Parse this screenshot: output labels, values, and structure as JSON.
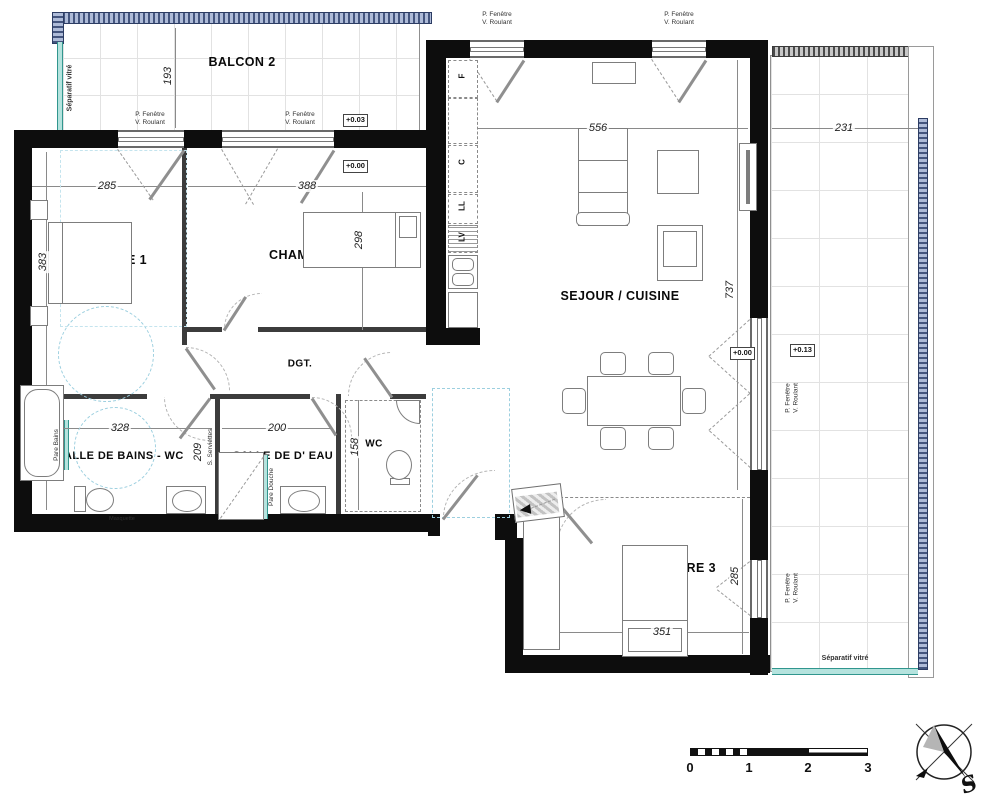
{
  "rooms": {
    "balcon2": "BALCON 2",
    "chambre1": "CHAMBRE 1",
    "chambre2": "CHAMBRE 2",
    "sejour": "SEJOUR / CUISINE",
    "balcon1": "BALCON 1",
    "dgt": "DGT.",
    "sdb": "SALLE DE BAINS - WC",
    "sde": "SALLE DE D' EAU",
    "wc": "WC",
    "chambre3": "CHAMBRE 3",
    "pi": "PI."
  },
  "dims": {
    "d193": "193",
    "d285": "285",
    "d388": "388",
    "d383": "383",
    "d298": "298",
    "d556": "556",
    "d231": "231",
    "d737": "737",
    "d328": "328",
    "d209": "209",
    "d200": "200",
    "d158": "158",
    "d351": "351",
    "d285b": "285"
  },
  "levels": {
    "balcon2": "+0.03",
    "chambre2": "+0.00",
    "sejour": "+0.00",
    "balcon1": "+0.13"
  },
  "win": {
    "l1": "P. Fenêtre",
    "l2": "V. Roulant"
  },
  "notes": {
    "separatif": "Séparatif vitré",
    "pare_bains": "Pare Bains",
    "s_serviettes": "S. Serviettes",
    "pare_douche": "Pare Douche",
    "masquette": "Masquette"
  },
  "kitchen": {
    "f": "F",
    "c": "C",
    "ll": "LL",
    "lv": "LV"
  },
  "scale": {
    "n0": "0",
    "n1": "1",
    "n2": "2",
    "n3": "3"
  },
  "compass": {
    "s": "S"
  }
}
